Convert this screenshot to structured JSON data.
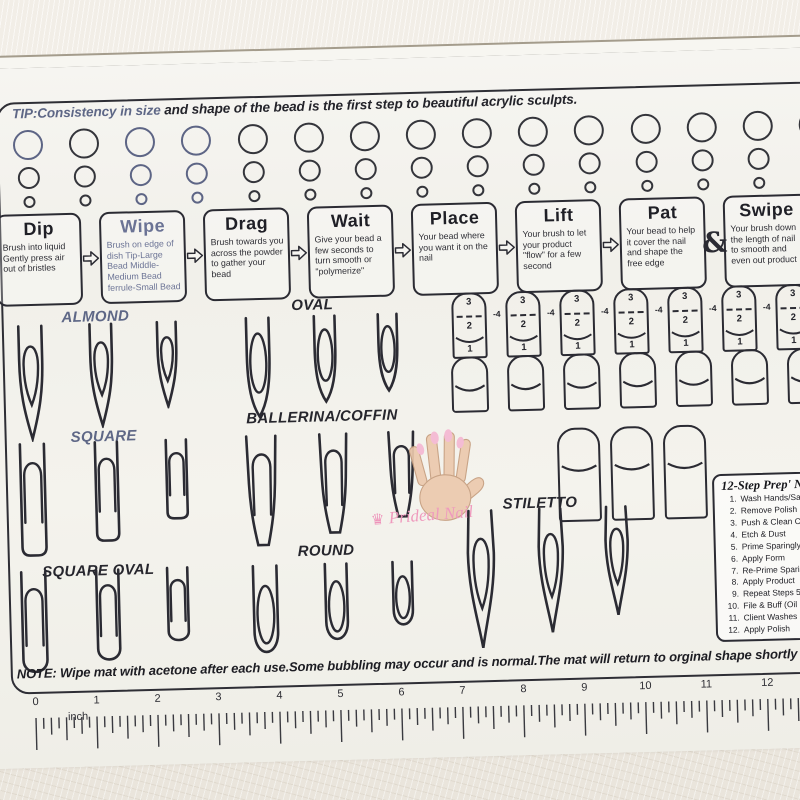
{
  "tip": {
    "highlight": "TIP:Consistency in size",
    "rest": " and shape of the bead is the first step to beautiful acrylic sculpts."
  },
  "beads": {
    "columns": 15,
    "sizes": [
      "large",
      "medium",
      "small"
    ]
  },
  "steps": {
    "items": [
      {
        "title": "Dip",
        "desc": "Brush into liquid Gently press air out of bristles"
      },
      {
        "title": "Wipe",
        "desc": "Brush on edge of dish Tip-Large Bead Middle-Medium Bead ferrule-Small Bead"
      },
      {
        "title": "Drag",
        "desc": "Brush towards you across the powder to gather your bead"
      },
      {
        "title": "Wait",
        "desc": "Give your bead a few seconds to turn smooth or \"polymerize\""
      },
      {
        "title": "Place",
        "desc": "Your bead where you want it on the nail"
      },
      {
        "title": "Lift",
        "desc": "Your brush to let your product \"flow\" for a few second"
      },
      {
        "title": "Pat",
        "desc": "Your bead to help it cover the nail and shape the free edge"
      },
      {
        "title": "Swipe",
        "desc": "Your brush down the length of nail to smooth and even out product"
      }
    ],
    "connectors": [
      "arrow",
      "arrow",
      "arrow",
      "arrow",
      "arrow",
      "arrow",
      "amp"
    ]
  },
  "guides": {
    "zones": [
      "3",
      "2",
      "1"
    ],
    "marker": "-4",
    "numbered_count": 7,
    "plain_count": 7,
    "side_count": 3
  },
  "sections": [
    {
      "label": "ALMOND",
      "shape": "almond",
      "tint": "blue",
      "count": 3
    },
    {
      "label": "OVAL",
      "shape": "oval",
      "tint": "dark",
      "count": 3
    },
    {
      "label": "SQUARE",
      "shape": "square",
      "tint": "blue",
      "count": 3
    },
    {
      "label": "BALLERINA/COFFIN",
      "shape": "coffin",
      "tint": "dark",
      "count": 3
    },
    {
      "label": "SQUARE OVAL",
      "shape": "squoval",
      "tint": "dark",
      "count": 3
    },
    {
      "label": "ROUND",
      "shape": "round",
      "tint": "dark",
      "count": 3
    },
    {
      "label": "STILETTO",
      "shape": "stiletto",
      "tint": "dark",
      "count": 3
    }
  ],
  "logo": {
    "brand": "Prideal Nail",
    "crown": "♛"
  },
  "prep_list": {
    "title": "12-Step Prep' N",
    "items": [
      {
        "num": "1.",
        "text": "Wash Hands/Sanitize"
      },
      {
        "num": "2.",
        "text": "Remove Polish"
      },
      {
        "num": "3.",
        "text": "Push & Clean Cuticles"
      },
      {
        "num": "4.",
        "text": "Etch & Dust"
      },
      {
        "num": "5.",
        "text": "Prime Sparingly &"
      },
      {
        "num": "6.",
        "text": "Apply Form"
      },
      {
        "num": "7.",
        "text": "Re-Prime Sparingly"
      },
      {
        "num": "8.",
        "text": "Apply Product"
      },
      {
        "num": "9.",
        "text": "Repeat Steps 5-8"
      },
      {
        "num": "10.",
        "text": "File & Buff  (Oil"
      },
      {
        "num": "11.",
        "text": "Client Washes Hands"
      },
      {
        "num": "12.",
        "text": "Apply Polish"
      }
    ]
  },
  "note": "NOTE: Wipe mat with acetone after each use.Some bubbling may occur and is normal.The mat will return to orginal shape shortly after clean",
  "ruler": {
    "unit": "inch",
    "numbers": [
      "0",
      "1",
      "2",
      "3",
      "4",
      "5",
      "6",
      "7",
      "8",
      "9",
      "10",
      "11",
      "12"
    ]
  },
  "colors": {
    "ink": "#2b2b33",
    "blue_ink": "#5e6786",
    "pink": "#ef93ba",
    "mat": "#f3f2ed",
    "wall": "#eae5dc"
  }
}
